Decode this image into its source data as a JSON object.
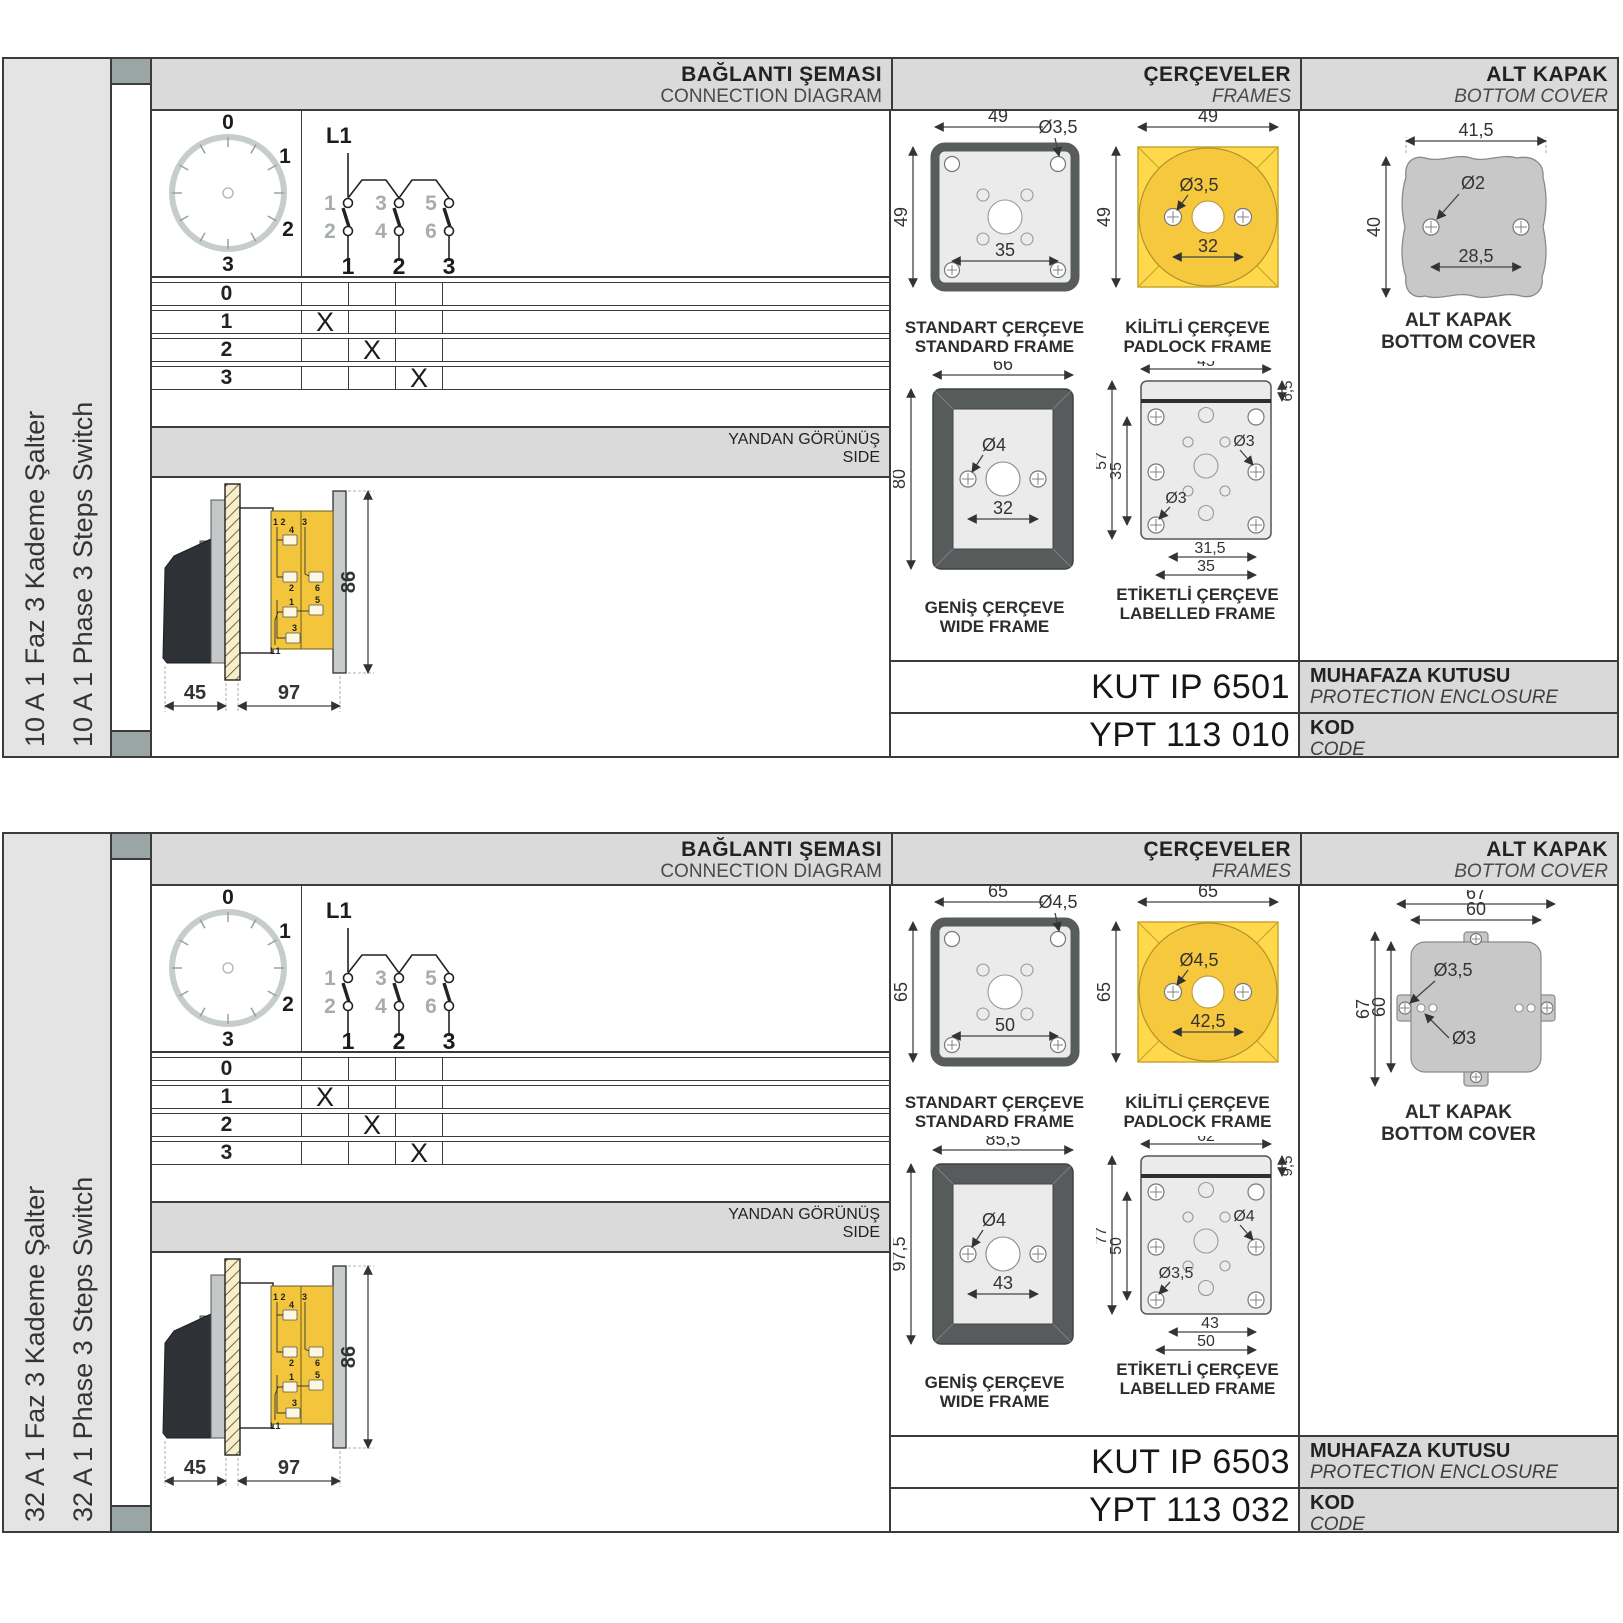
{
  "products": [
    {
      "sidebar": {
        "label_tr": "10 A 1 Faz 3 Kademe Şalter",
        "label_en": "10 A 1 Phase 3 Steps Switch"
      },
      "headers": {
        "connection_tr": "BAĞLANTI ŞEMASI",
        "connection_en": "CONNECTION DIAGRAM",
        "frames_tr": "ÇERÇEVELER",
        "frames_en": "FRAMES",
        "cover_tr": "ALT KAPAK",
        "cover_en": "BOTTOM COVER"
      },
      "connection": {
        "line_label": "L1",
        "dial_positions": [
          "0",
          "1",
          "2",
          "3"
        ],
        "upper_contacts": [
          "1",
          "3",
          "5"
        ],
        "lower_contacts": [
          "2",
          "4",
          "6"
        ],
        "pole_labels": [
          "1",
          "2",
          "3"
        ],
        "table_rows": [
          {
            "label": "0",
            "c1": "",
            "c2": "",
            "c3": ""
          },
          {
            "label": "1",
            "c1": "X",
            "c2": "",
            "c3": ""
          },
          {
            "label": "2",
            "c1": "",
            "c2": "X",
            "c3": ""
          },
          {
            "label": "3",
            "c1": "",
            "c2": "",
            "c3": "X"
          }
        ]
      },
      "side_view": {
        "title_tr": "YANDAN GÖRÜNÜŞ",
        "title_en": "SIDE",
        "dim_front": "45",
        "dim_body": "97",
        "dim_height": "86",
        "terminals": {
          "pair": "1 2",
          "top_right": "3",
          "b4": "4",
          "b2": "2",
          "b6": "6",
          "b1": "1",
          "b5": "5",
          "b3": "3",
          "line": "L1"
        }
      },
      "frames": {
        "standard": {
          "cap_tr": "STANDART ÇERÇEVE",
          "cap_en": "STANDARD FRAME",
          "dim_w": "49",
          "dim_h": "49",
          "dim_hole": "Ø3,5",
          "dim_pitch": "35"
        },
        "padlock": {
          "cap_tr": "KİLİTLİ ÇERÇEVE",
          "cap_en": "PADLOCK FRAME",
          "dim_w": "49",
          "dim_h": "49",
          "dim_hole": "Ø3,5",
          "dim_pitch": "32"
        },
        "wide": {
          "cap_tr": "GENİŞ ÇERÇEVE",
          "cap_en": "WIDE FRAME",
          "dim_w": "66",
          "dim_h": "80",
          "dim_hole": "Ø4",
          "dim_pitch": "32"
        },
        "labelled": {
          "cap_tr": "ETİKETLİ ÇERÇEVE",
          "cap_en": "LABELLED FRAME",
          "dim_w": "45",
          "dim_h": "57",
          "dim_h2": "35",
          "dim_band": "6,5",
          "dim_hole_r": "Ø3",
          "dim_hole_b": "Ø3",
          "dim_p1": "31,5",
          "dim_p2": "35"
        }
      },
      "cover": {
        "cap_tr": "ALT KAPAK",
        "cap_en": "BOTTOM COVER",
        "dim_w": "41,5",
        "dim_h": "40",
        "dim_hole": "Ø2",
        "dim_pitch": "28,5"
      },
      "enclosure": {
        "value": "KUT IP 6501",
        "label_tr": "MUHAFAZA KUTUSU",
        "label_en": "PROTECTION ENCLOSURE"
      },
      "code": {
        "value": "YPT 113 010",
        "label_tr": "KOD",
        "label_en": "CODE"
      }
    },
    {
      "sidebar": {
        "label_tr": "32 A 1 Faz 3 Kademe Şalter",
        "label_en": "32 A 1 Phase 3 Steps Switch"
      },
      "headers": {
        "connection_tr": "BAĞLANTI ŞEMASI",
        "connection_en": "CONNECTION DIAGRAM",
        "frames_tr": "ÇERÇEVELER",
        "frames_en": "FRAMES",
        "cover_tr": "ALT KAPAK",
        "cover_en": "BOTTOM COVER"
      },
      "connection": {
        "line_label": "L1",
        "dial_positions": [
          "0",
          "1",
          "2",
          "3"
        ],
        "upper_contacts": [
          "1",
          "3",
          "5"
        ],
        "lower_contacts": [
          "2",
          "4",
          "6"
        ],
        "pole_labels": [
          "1",
          "2",
          "3"
        ],
        "table_rows": [
          {
            "label": "0",
            "c1": "",
            "c2": "",
            "c3": ""
          },
          {
            "label": "1",
            "c1": "X",
            "c2": "",
            "c3": ""
          },
          {
            "label": "2",
            "c1": "",
            "c2": "X",
            "c3": ""
          },
          {
            "label": "3",
            "c1": "",
            "c2": "",
            "c3": "X"
          }
        ]
      },
      "side_view": {
        "title_tr": "YANDAN GÖRÜNÜŞ",
        "title_en": "SIDE",
        "dim_front": "45",
        "dim_body": "97",
        "dim_height": "86",
        "terminals": {
          "pair": "1 2",
          "top_right": "3",
          "b4": "4",
          "b2": "2",
          "b6": "6",
          "b1": "1",
          "b5": "5",
          "b3": "3",
          "line": "L1"
        }
      },
      "frames": {
        "standard": {
          "cap_tr": "STANDART ÇERÇEVE",
          "cap_en": "STANDARD FRAME",
          "dim_w": "65",
          "dim_h": "65",
          "dim_hole": "Ø4,5",
          "dim_pitch": "50"
        },
        "padlock": {
          "cap_tr": "KİLİTLİ ÇERÇEVE",
          "cap_en": "PADLOCK FRAME",
          "dim_w": "65",
          "dim_h": "65",
          "dim_hole": "Ø4,5",
          "dim_pitch": "42,5"
        },
        "wide": {
          "cap_tr": "GENİŞ ÇERÇEVE",
          "cap_en": "WIDE FRAME",
          "dim_w": "85,5",
          "dim_h": "97,5",
          "dim_hole": "Ø4",
          "dim_pitch": "43"
        },
        "labelled": {
          "cap_tr": "ETİKETLİ ÇERÇEVE",
          "cap_en": "LABELLED FRAME",
          "dim_w": "62",
          "dim_h": "77",
          "dim_h2": "50",
          "dim_band": "9,5",
          "dim_hole_r": "Ø4",
          "dim_hole_b": "Ø3,5",
          "dim_p1": "43",
          "dim_p2": "50"
        }
      },
      "cover": {
        "cap_tr": "ALT KAPAK",
        "cap_en": "BOTTOM COVER",
        "dim_w_out": "67",
        "dim_w_in": "60",
        "dim_h_out": "67",
        "dim_h_in": "60",
        "dim_hole1": "Ø3,5",
        "dim_hole2": "Ø3"
      },
      "enclosure": {
        "value": "KUT IP 6503",
        "label_tr": "MUHAFAZA KUTUSU",
        "label_en": "PROTECTION ENCLOSURE"
      },
      "code": {
        "value": "YPT 113 032",
        "label_tr": "KOD",
        "label_en": "CODE"
      }
    }
  ]
}
